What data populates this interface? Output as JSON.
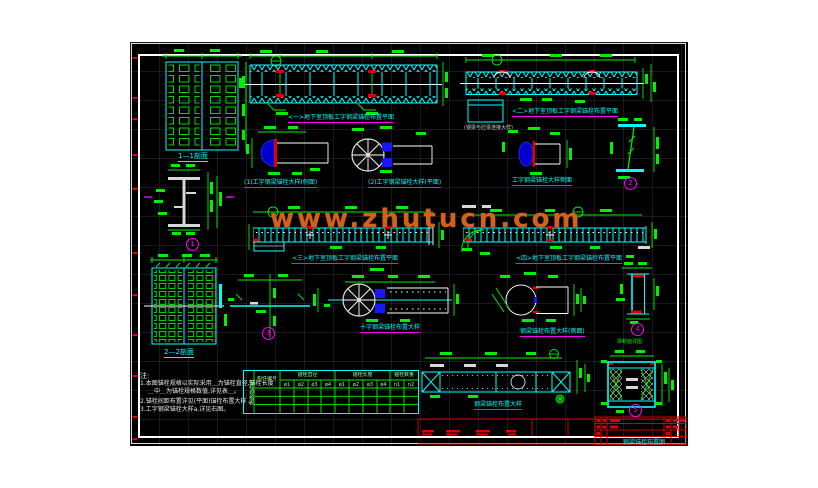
{
  "watermark": "www.zhutucn.com",
  "colors": {
    "canvas_background": "#000000",
    "line_cyan": "#00ffff",
    "line_green": "#00f000",
    "line_white": "#ffffff",
    "accent_red": "#ff0000",
    "accent_blue": "#1616ff",
    "callout_magenta": "#ff00ff",
    "watermark_orange": "#d2611c",
    "titleblock_red": "#cc0000"
  },
  "drawings": {
    "section11": {
      "label": "1—1剖面"
    },
    "section22": {
      "label": "2—2剖面"
    },
    "beam1": {
      "label": "<一>地下室顶板工字钢梁锚栓布置平面"
    },
    "beam2": {
      "label": "<二>地下室顶板工字钢梁锚栓布置平面"
    },
    "beam3": {
      "label": "<三>地下室顶板工字钢梁锚栓布置平面"
    },
    "beam4": {
      "label": "<四>地下室顶板工字钢梁锚栓布置平面"
    },
    "conn": {
      "label": "(钢梁与砼梁连接大样)"
    },
    "detail1": {
      "label": "(1)工字钢梁锚栓大样(侧面)"
    },
    "detail2": {
      "label": "(2)工字钢梁锚栓大样(平面)"
    },
    "detail_side": {
      "label": "工字钢梁锚栓大样侧面"
    },
    "cross": {
      "label": "十字钢梁锚栓布置大样"
    },
    "circle": {
      "label": "钢梁锚栓布置大样(侧面)"
    },
    "plan": {
      "label": "钢梁锚栓布置大样"
    },
    "box": {
      "label": "梁断面详图"
    }
  },
  "callouts": {
    "c1": "1",
    "c2": "2",
    "c3": "3",
    "c4": "4",
    "c5": "5"
  },
  "notes": {
    "title": "注:",
    "lines": [
      "1.本图锚栓规格以实际采用＿为锚栓直径,锚栓长度",
      "＿中＿为锚栓规格数值,详见表＿。",
      "2.锚栓间距布置详见(平面)锚栓布置大样 。",
      "3.工字钢梁锚栓大样a,详见右图。"
    ]
  },
  "table": {
    "corner": "锚栓规格表",
    "component": "构件编号",
    "groups": [
      {
        "title": "锚栓直径",
        "cols": [
          "ø1",
          "ø2",
          "ø3",
          "ø4"
        ]
      },
      {
        "title": "锚栓长度",
        "cols": [
          "ø1",
          "ø2",
          "ø3",
          "ø4"
        ]
      },
      {
        "title": "锚栓数量",
        "cols": [
          "n1",
          "n2"
        ]
      }
    ]
  },
  "titleblock": {
    "title": "钢梁锚栓布置图"
  }
}
